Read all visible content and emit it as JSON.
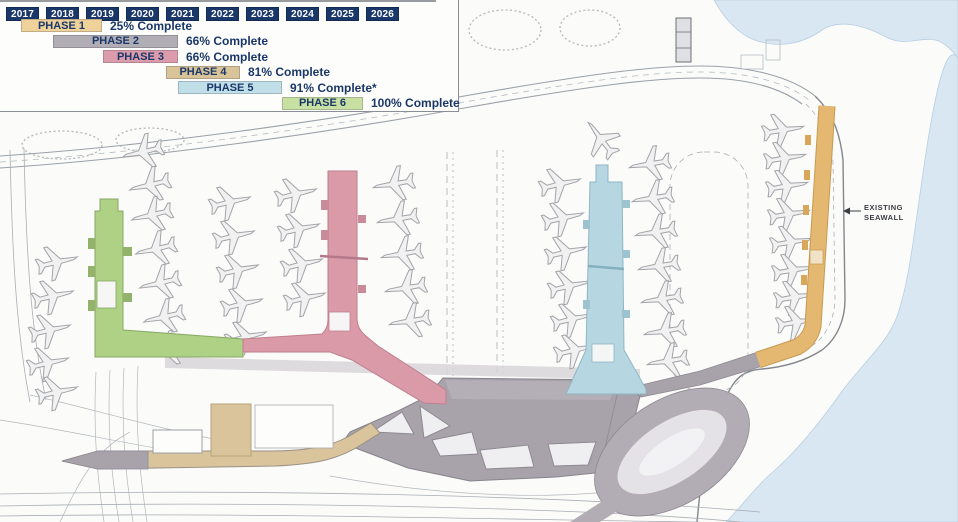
{
  "legend": {
    "years": [
      "2017",
      "2018",
      "2019",
      "2020",
      "2021",
      "2022",
      "2023",
      "2024",
      "2025",
      "2026"
    ],
    "phases": [
      {
        "label": "PHASE 1",
        "status": "25% Complete",
        "years_span": "2017–2019",
        "bar_color": "#eed29a",
        "bar_left": 21,
        "bar_width": 81
      },
      {
        "label": "PHASE 2",
        "status": "66% Complete",
        "years_span": "2018–2021",
        "bar_color": "#b1adb5",
        "bar_left": 53,
        "bar_width": 125
      },
      {
        "label": "PHASE 3",
        "status": "66% Complete",
        "years_span": "2019–2021",
        "bar_color": "#dc9cab",
        "bar_left": 103,
        "bar_width": 75
      },
      {
        "label": "PHASE 4",
        "status": "81% Complete",
        "years_span": "2021–2023",
        "bar_color": "#d9c398",
        "bar_left": 166,
        "bar_width": 74
      },
      {
        "label": "PHASE 5",
        "status": "91% Complete*",
        "years_span": "2021–2024",
        "bar_color": "#c1dfe9",
        "bar_left": 178,
        "bar_width": 104
      },
      {
        "label": "PHASE 6",
        "status": "100% Complete",
        "years_span": "2024–2026",
        "bar_color": "#c9e0a3",
        "bar_left": 282,
        "bar_width": 81
      }
    ]
  },
  "map": {
    "seawall_label_line1": "EXISTING",
    "seawall_label_line2": "SEAWALL",
    "colors": {
      "navy": "#1a3769",
      "water": "#d9e7f2",
      "water_edge": "#b7cfe3",
      "phase1_gold": "#e4b870",
      "phase2_gray": "#a8a3ab",
      "phase3_pink": "#db9aa7",
      "phase4_tan": "#d9c49c",
      "phase5_blue": "#b6d7e1",
      "phase6_green": "#afd186",
      "roof_light": "#b4afb6",
      "apron_gray": "#d8d5d9"
    },
    "aircraft": [
      [
        57,
        262,
        76
      ],
      [
        53,
        296,
        76
      ],
      [
        50,
        330,
        76
      ],
      [
        48,
        363,
        76
      ],
      [
        57,
        392,
        76
      ],
      [
        143,
        152,
        -104
      ],
      [
        150,
        185,
        -104
      ],
      [
        152,
        215,
        -104
      ],
      [
        156,
        249,
        -104
      ],
      [
        160,
        283,
        -104
      ],
      [
        164,
        317,
        -104
      ],
      [
        167,
        349,
        -104
      ],
      [
        230,
        202,
        76
      ],
      [
        234,
        236,
        76
      ],
      [
        238,
        270,
        76
      ],
      [
        242,
        304,
        76
      ],
      [
        246,
        337,
        76
      ],
      [
        296,
        194,
        76
      ],
      [
        299,
        229,
        76
      ],
      [
        302,
        264,
        76
      ],
      [
        305,
        298,
        76
      ],
      [
        394,
        184,
        -100
      ],
      [
        398,
        219,
        -100
      ],
      [
        402,
        254,
        -100
      ],
      [
        406,
        288,
        -100
      ],
      [
        410,
        321,
        -100
      ],
      [
        560,
        184,
        76
      ],
      [
        563,
        218,
        76
      ],
      [
        566,
        252,
        76
      ],
      [
        569,
        286,
        76
      ],
      [
        572,
        319,
        76
      ],
      [
        575,
        350,
        76
      ],
      [
        650,
        164,
        -100
      ],
      [
        653,
        198,
        -100
      ],
      [
        656,
        232,
        -100
      ],
      [
        659,
        266,
        -100
      ],
      [
        662,
        299,
        -100
      ],
      [
        665,
        331,
        -100
      ],
      [
        668,
        361,
        -100
      ],
      [
        783,
        130,
        80
      ],
      [
        785,
        158,
        80
      ],
      [
        787,
        186,
        80
      ],
      [
        789,
        214,
        80
      ],
      [
        791,
        242,
        80
      ],
      [
        793,
        270,
        80
      ],
      [
        795,
        297,
        80
      ],
      [
        797,
        322,
        80
      ],
      [
        601,
        139,
        -38
      ]
    ]
  }
}
